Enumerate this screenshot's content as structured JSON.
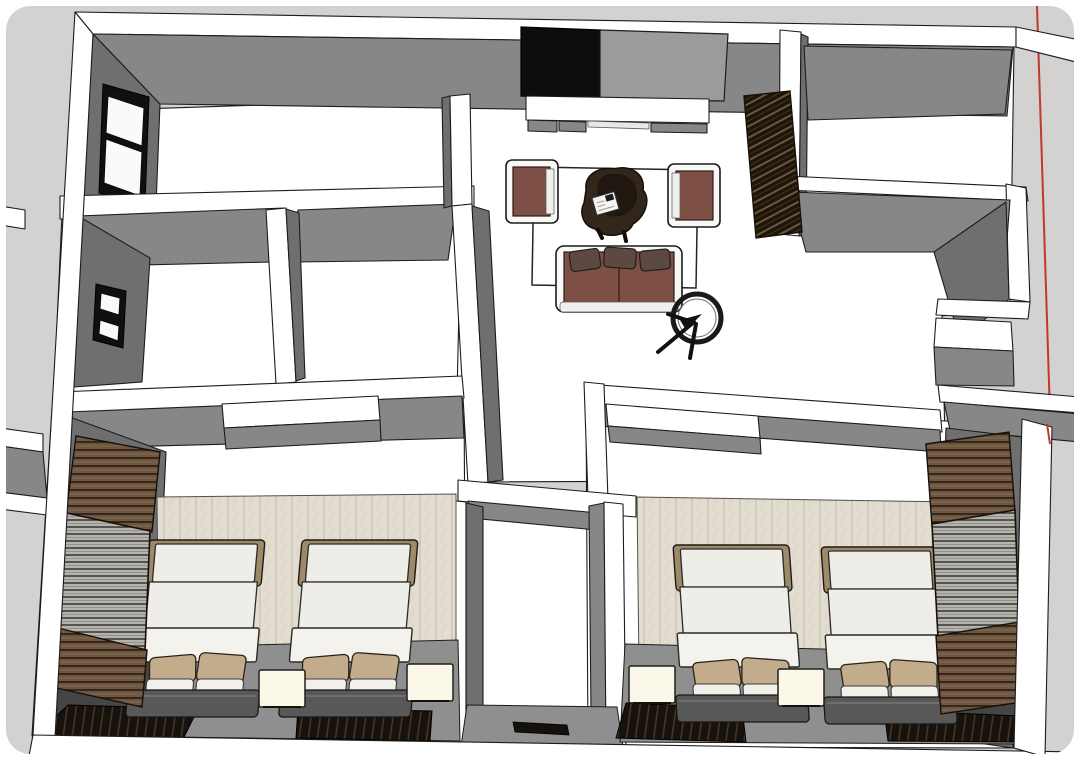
{
  "view": {
    "type": "3d-model-viewport",
    "label": "Apartment interior 3D model, top-down perspective cutaway view with red drawing axis",
    "style": "sketch-render, white wall tops, gray wall faces"
  },
  "palette": {
    "canvas": "#d3d2d0",
    "wall_top": "#ffffff",
    "face_mid": "#878787",
    "face_dark": "#6f6f6f",
    "face_light": "#9b9b9b",
    "floor_gray": "#8f8f8f",
    "floor_shadow": "#454545",
    "outline": "#1c1c1c",
    "axis_red": "#c0392b",
    "tv_black": "#0d0d0d",
    "maroon": "#7d4f45",
    "pillow_dark": "#5c4a42",
    "table_brown": "#33261a",
    "table_brown_dark": "#1f1710",
    "white_frame": "#f8f8f6",
    "curtain_brown": "#6e5640",
    "curtain_dark": "#2a2017",
    "blind_gray": "#b5b3ae",
    "plaster": "#e2ddd0",
    "plaster_dark": "#c6bfad",
    "bed_white": "#efede7",
    "bed_fold": "#f4f2ec",
    "headboard_tan": "#9c8a6a",
    "pillow_tan": "#c2ac8b",
    "pillow_white": "#f2f0ea",
    "bed_base": "#585858",
    "nightstand": "#fbf8e9",
    "rug_dark": "#17120d",
    "rug_stripe": "#4a3b26",
    "mat_black": "#14100c"
  },
  "scene": {
    "rooms": [
      {
        "name": "living-room",
        "furniture": [
          "wall-tv",
          "tv-side-panel",
          "media-console",
          "armchair-left",
          "armchair-right",
          "sofa-with-pillows",
          "organic-coffee-table",
          "open-book",
          "ring-floor-stand",
          "area-rug-outline",
          "slat-blind-panel"
        ]
      },
      {
        "name": "bathroom-left",
        "furniture": [
          "window-small"
        ]
      },
      {
        "name": "bathroom-right",
        "furniture": []
      },
      {
        "name": "bedroom-left",
        "furniture": [
          "twin-bed",
          "twin-bed",
          "nightstand",
          "nightstand",
          "dark-rug",
          "dark-rug",
          "window-with-wood-curtains",
          "plaster-headboard-wall"
        ]
      },
      {
        "name": "bedroom-right",
        "furniture": [
          "twin-bed",
          "twin-bed",
          "nightstand",
          "nightstand",
          "dark-rug",
          "dark-rug",
          "window-with-wood-curtains",
          "plaster-headboard-wall"
        ]
      },
      {
        "name": "hallway",
        "furniture": [
          "door-mat"
        ]
      },
      {
        "name": "closet-niche",
        "furniture": []
      }
    ]
  }
}
